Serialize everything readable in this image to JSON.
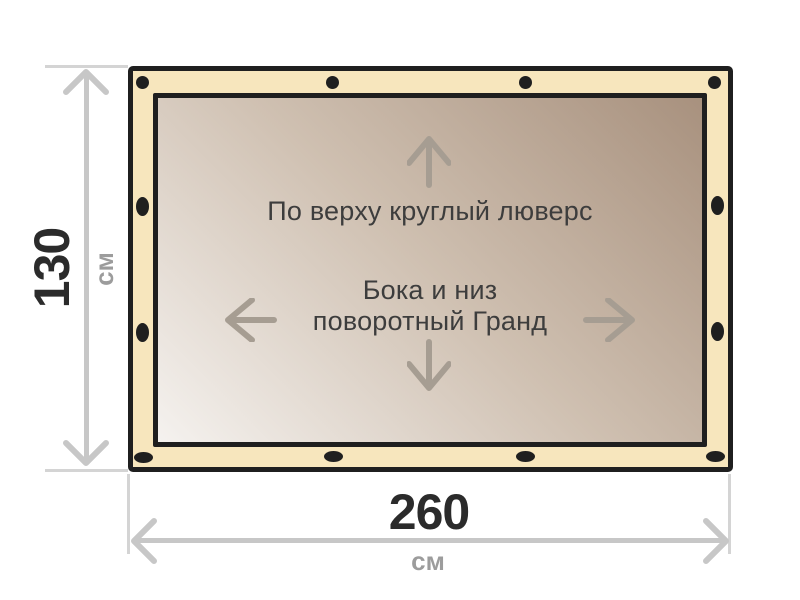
{
  "diagram": {
    "inner_notes": {
      "top_edge_note": "По верху круглый люверс",
      "center_note_line1": "Бока и низ",
      "center_note_line2": "поворотный Гранд"
    },
    "height_dimension": {
      "value": "130",
      "unit": "см"
    },
    "width_dimension": {
      "value": "260",
      "unit": "см"
    },
    "grommets": {
      "top_edge": {
        "type": "round",
        "count": 4
      },
      "bottom_edge": {
        "type": "oval",
        "count": 4
      },
      "left_edge": {
        "type": "oval",
        "count": 2
      },
      "right_edge": {
        "type": "oval",
        "count": 2
      }
    },
    "colors": {
      "frame_outline": "#1f1f1f",
      "edge_band": "#f7e6bd",
      "fabric_light": "#f5f2ef",
      "fabric_dark": "#a8917e",
      "dimension_line": "#c7c7c7",
      "inner_arrow": "#a69d92",
      "dimension_number": "#2b2b2b",
      "dimension_unit": "#9c9c9c",
      "note_text": "#3d3d3d"
    }
  }
}
